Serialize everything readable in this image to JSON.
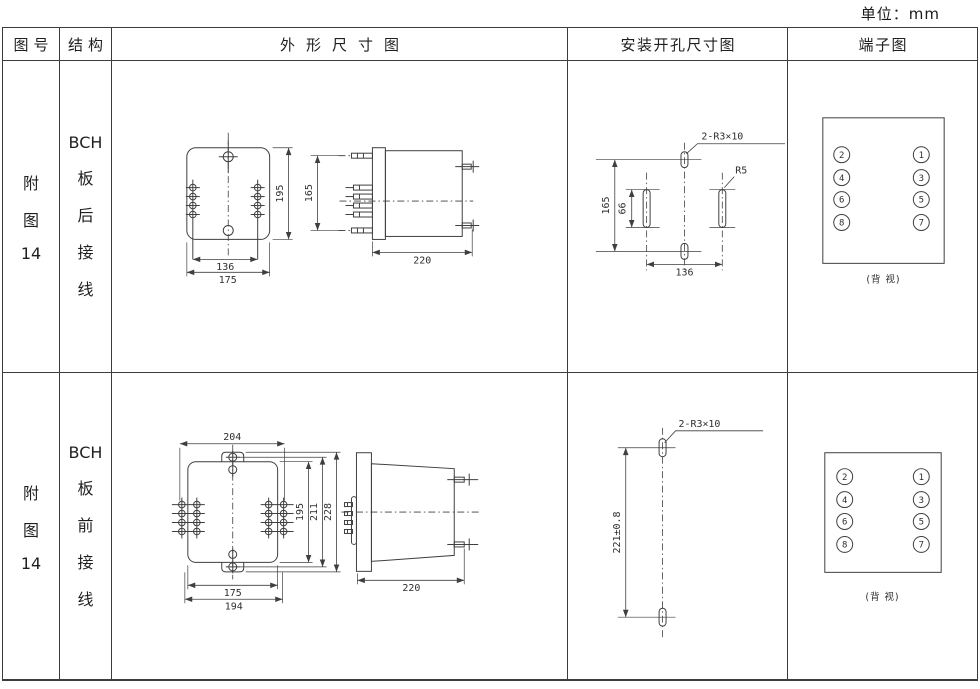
{
  "page": {
    "unit_label": "单位：mm"
  },
  "header": {
    "figure_no": "图号",
    "structure": "结构",
    "outline": "外形尺寸图",
    "mounting": "安装开孔尺寸图",
    "terminal": "端子图"
  },
  "rows": [
    {
      "figure": {
        "l1": "附",
        "l2": "图",
        "l3": "14"
      },
      "structure": {
        "l1": "BCH",
        "l2": "板",
        "l3": "后",
        "l4": "接",
        "l5": "线"
      },
      "outline": {
        "front_height": "195",
        "pin_span": "136",
        "front_width": "175",
        "side_height": "165",
        "side_depth": "220"
      },
      "mounting": {
        "slot_label": "2-R3×10",
        "corner_label": "R5",
        "height": "165",
        "slot_length": "66",
        "span": "136"
      },
      "terminal": {
        "left": [
          "2",
          "4",
          "6",
          "8"
        ],
        "right": [
          "1",
          "3",
          "5",
          "7"
        ],
        "caption": "(背 视)"
      }
    },
    {
      "figure": {
        "l1": "附",
        "l2": "图",
        "l3": "14"
      },
      "structure": {
        "l1": "BCH",
        "l2": "板",
        "l3": "前",
        "l4": "接",
        "l5": "线"
      },
      "outline": {
        "top_width": "204",
        "height_inner": "195",
        "height_mid": "211",
        "height_outer": "228",
        "width_inner": "175",
        "width_outer": "194",
        "side_depth": "220"
      },
      "mounting": {
        "slot_label": "2-R3×10",
        "span_v": "221±0.8"
      },
      "terminal": {
        "left": [
          "2",
          "4",
          "6",
          "8"
        ],
        "right": [
          "1",
          "3",
          "5",
          "7"
        ],
        "caption": "(背 视)"
      }
    }
  ]
}
